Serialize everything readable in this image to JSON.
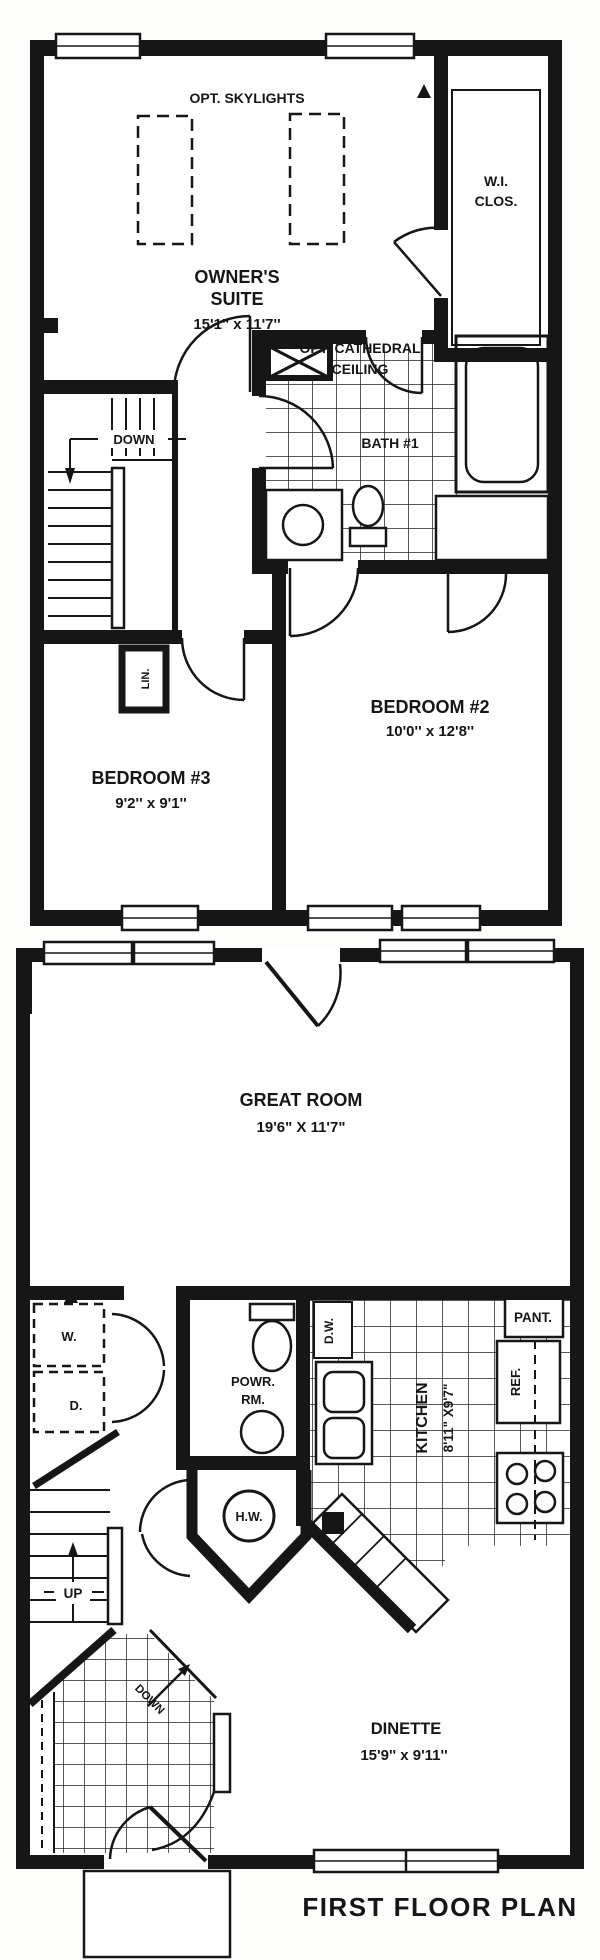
{
  "colors": {
    "ink": "#161616",
    "paper": "#ffffff"
  },
  "upper_plan": {
    "skylights": "OPT. SKYLIGHTS",
    "owners_suite_line1": "OWNER'S",
    "owners_suite_line2": "SUITE",
    "owners_suite_dims": "15'1'' x 11'7''",
    "cathedral_line1": "OPT. CATHEDRAL",
    "cathedral_line2": "CEILING",
    "wi_line1": "W.I.",
    "wi_line2": "CLOS.",
    "bath": "BATH #1",
    "down": "DOWN",
    "linen": "LIN.",
    "bedroom2": "BEDROOM #2",
    "bedroom2_dims": "10'0'' x 12'8''",
    "bedroom3": "BEDROOM #3",
    "bedroom3_dims": "9'2'' x 9'1''"
  },
  "lower_plan": {
    "great_room": "GREAT ROOM",
    "great_room_dims": "19'6\" X 11'7\"",
    "washer": "W.",
    "dryer": "D.",
    "powder_line1": "POWR.",
    "powder_line2": "RM.",
    "dishwasher": "D.W.",
    "hot_water": "H.W.",
    "kitchen": "KITCHEN",
    "kitchen_dims": "8'11\" X9'7\"",
    "pantry": "PANT.",
    "refrigerator": "REF.",
    "up": "UP",
    "down": "DOWN",
    "dinette": "DINETTE",
    "dinette_dims": "15'9'' x 9'11''",
    "title": "FIRST FLOOR PLAN"
  }
}
